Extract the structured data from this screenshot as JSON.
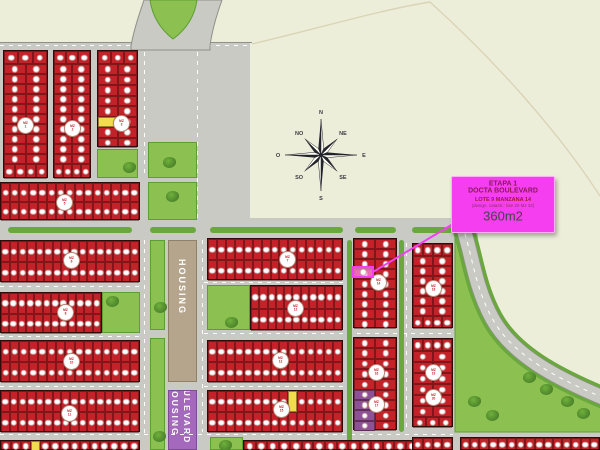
{
  "info_box": {
    "etapa": "ETAPA 1",
    "project": "DOCTA BOULEVARD",
    "lote": "LOTE 9 MANZANA 14",
    "catastro": "(design. catastr.:  lote 20 Mz 32)",
    "area": "360m2"
  },
  "selected_lot": {
    "etapa": "1",
    "manzana": "14",
    "lote": "9",
    "area_m2": 360
  },
  "compass": {
    "labels": [
      "N",
      "NE",
      "E",
      "SE",
      "S",
      "SO",
      "O",
      "NO"
    ]
  },
  "street_labels": {
    "housing_road": "HOUSING",
    "boulevard_word1": "HOUSING",
    "boulevard_word2": "BOULEVARD"
  },
  "commercial_blocks": [
    {
      "area": "7200.00 m2",
      "desc1": "Lote destinado a uso",
      "desc2": "comercial. residencial"
    },
    {
      "area": "7500.00 m2",
      "desc1": "Lote destinado a uso",
      "desc2": "comercial. residencial"
    }
  ],
  "legend_colors": {
    "lot_red": "#c32228",
    "lot_yellow": "#f0dc4e",
    "lot_purple": "#8d5196",
    "park_green": "#8cc152",
    "road_gray": "#c9cac3",
    "median_green": "#6aa83e",
    "strip_tan": "#b5a58d",
    "strip_purple": "#a469bd",
    "highlight_magenta": "#f23ff0"
  },
  "map": {
    "road_panels": [
      [
        0,
        42,
        250,
        408
      ],
      [
        197,
        218,
        281,
        232
      ],
      [
        453,
        425,
        147,
        25
      ]
    ],
    "dashes_h": [
      [
        0,
        45,
        250
      ],
      [
        0,
        286,
        140
      ],
      [
        0,
        336,
        140
      ],
      [
        0,
        386,
        140
      ],
      [
        0,
        434,
        453
      ],
      [
        204,
        282,
        139
      ],
      [
        204,
        333,
        256
      ],
      [
        204,
        386,
        139
      ]
    ],
    "dashes_v": [
      [
        144,
        52,
        126
      ],
      [
        197,
        52,
        166
      ],
      [
        144,
        240,
        194
      ],
      [
        202,
        240,
        192
      ],
      [
        406,
        243,
        188
      ]
    ],
    "medians": [
      [
        8,
        227,
        124,
        6
      ],
      [
        150,
        227,
        46,
        6
      ],
      [
        210,
        227,
        133,
        6
      ],
      [
        355,
        227,
        41,
        6
      ],
      [
        412,
        227,
        41,
        6
      ],
      [
        347,
        240,
        5,
        210
      ],
      [
        399,
        240,
        5,
        192
      ]
    ],
    "bars": [
      [
        455,
        232,
        7,
        200
      ]
    ],
    "parks": [
      [
        97,
        149,
        41,
        29
      ],
      [
        102,
        292,
        38,
        41
      ],
      [
        207,
        285,
        43,
        45
      ],
      [
        148,
        142,
        49,
        36
      ],
      [
        148,
        182,
        49,
        38
      ],
      [
        150,
        240,
        15,
        90
      ],
      [
        150,
        338,
        15,
        112
      ],
      [
        210,
        437,
        33,
        13
      ]
    ],
    "curve_trees": [
      [
        540,
        384
      ],
      [
        561,
        396
      ],
      [
        523,
        372
      ],
      [
        577,
        408
      ],
      [
        468,
        396
      ],
      [
        486,
        410
      ]
    ],
    "blocks": [
      {
        "name": "mz-1",
        "x": 3,
        "y": 50,
        "w": 45,
        "h": 128,
        "groups": [
          [
            1,
            3,
            13
          ],
          [
            10,
            2,
            10
          ],
          [
            1,
            4,
            15
          ]
        ],
        "specials": []
      },
      {
        "name": "mz-2",
        "x": 53,
        "y": 50,
        "w": 38,
        "h": 128,
        "groups": [
          [
            1,
            3,
            13
          ],
          [
            10,
            2,
            10
          ],
          [
            1,
            4,
            15
          ]
        ],
        "specials": []
      },
      {
        "name": "mz-3",
        "x": 97,
        "y": 50,
        "w": 41,
        "h": 97,
        "groups": [
          [
            1,
            3,
            13
          ],
          [
            8,
            2,
            10.5
          ]
        ],
        "specials": [
          [
            1,
            5,
            0,
            "lot_yellow"
          ]
        ]
      },
      {
        "name": "mz-5",
        "x": 0,
        "y": 182,
        "w": 140,
        "h": 38,
        "groups": [
          [
            2,
            15,
            19
          ]
        ],
        "specials": []
      },
      {
        "name": "mz-6",
        "x": 0,
        "y": 240,
        "w": 140,
        "h": 42,
        "groups": [
          [
            2,
            16,
            21
          ]
        ],
        "specials": []
      },
      {
        "name": "mz-8",
        "x": 0,
        "y": 292,
        "w": 102,
        "h": 41,
        "groups": [
          [
            2,
            12,
            20.5
          ]
        ],
        "specials": []
      },
      {
        "name": "mz-10",
        "x": 0,
        "y": 340,
        "w": 140,
        "h": 42,
        "groups": [
          [
            2,
            15,
            21
          ]
        ],
        "specials": []
      },
      {
        "name": "mz-11",
        "x": 0,
        "y": 390,
        "w": 140,
        "h": 42,
        "groups": [
          [
            2,
            16,
            21
          ]
        ],
        "specials": []
      },
      {
        "name": "row-south-left",
        "x": 0,
        "y": 440,
        "w": 140,
        "h": 10,
        "groups": [
          [
            1,
            14,
            10
          ]
        ],
        "specials": [
          [
            0,
            0,
            3,
            "lot_yellow"
          ]
        ]
      },
      {
        "name": "mz-7",
        "x": 207,
        "y": 238,
        "w": 136,
        "h": 42,
        "groups": [
          [
            2,
            15,
            21
          ]
        ],
        "specials": []
      },
      {
        "name": "mz-12",
        "x": 250,
        "y": 285,
        "w": 93,
        "h": 45,
        "groups": [
          [
            2,
            11,
            22.5
          ]
        ],
        "specials": []
      },
      {
        "name": "mz-13",
        "x": 207,
        "y": 340,
        "w": 136,
        "h": 42,
        "groups": [
          [
            2,
            15,
            21
          ]
        ],
        "specials": []
      },
      {
        "name": "mz-15",
        "x": 207,
        "y": 390,
        "w": 136,
        "h": 42,
        "groups": [
          [
            2,
            15,
            21
          ]
        ],
        "specials": [
          [
            0,
            0,
            9,
            "lot_yellow"
          ]
        ]
      },
      {
        "name": "row-south-mid",
        "x": 243,
        "y": 440,
        "w": 187,
        "h": 10,
        "groups": [
          [
            1,
            16,
            10
          ]
        ],
        "specials": []
      },
      {
        "name": "mz-14",
        "x": 353,
        "y": 238,
        "w": 44,
        "h": 90,
        "groups": [
          [
            9,
            2,
            10
          ]
        ],
        "specials": []
      },
      {
        "name": "mz-16-17",
        "x": 353,
        "y": 337,
        "w": 44,
        "h": 93,
        "groups": [
          [
            9,
            2,
            10.34
          ]
        ],
        "specials": [
          [
            0,
            5,
            0,
            "lot_purple"
          ],
          [
            0,
            6,
            0,
            "lot_purple"
          ],
          [
            0,
            7,
            0,
            "lot_purple"
          ],
          [
            0,
            8,
            0,
            "lot_purple"
          ]
        ]
      },
      {
        "name": "mz-18",
        "x": 412,
        "y": 243,
        "w": 41,
        "h": 85,
        "groups": [
          [
            1,
            4,
            12
          ],
          [
            6,
            2,
            10
          ],
          [
            1,
            4,
            13
          ]
        ],
        "specials": []
      },
      {
        "name": "mz-19-20",
        "x": 412,
        "y": 338,
        "w": 41,
        "h": 89,
        "groups": [
          [
            1,
            4,
            12
          ],
          [
            6,
            2,
            11
          ],
          [
            1,
            3,
            11
          ]
        ],
        "specials": []
      },
      {
        "name": "row-south-right",
        "x": 412,
        "y": 437,
        "w": 41,
        "h": 13,
        "groups": [
          [
            1,
            4,
            13
          ]
        ],
        "specials": []
      },
      {
        "name": "row-south-far-right",
        "x": 460,
        "y": 437,
        "w": 140,
        "h": 13,
        "groups": [
          [
            1,
            15,
            13
          ]
        ],
        "specials": []
      }
    ],
    "badges": [
      [
        24,
        124,
        "1"
      ],
      [
        71,
        127,
        "2"
      ],
      [
        120,
        122,
        "3"
      ],
      [
        63,
        201,
        "5"
      ],
      [
        70,
        259,
        "6"
      ],
      [
        64,
        311,
        "8"
      ],
      [
        70,
        360,
        "10"
      ],
      [
        68,
        412,
        "11"
      ],
      [
        286,
        258,
        "7"
      ],
      [
        294,
        307,
        "12"
      ],
      [
        279,
        359,
        "13"
      ],
      [
        280,
        408,
        "15"
      ],
      [
        377,
        281,
        "14"
      ],
      [
        375,
        371,
        "16"
      ],
      [
        375,
        403,
        "17"
      ],
      [
        432,
        287,
        "18"
      ],
      [
        432,
        371,
        "19"
      ],
      [
        432,
        396,
        "20"
      ]
    ],
    "badge_prefix": "MZ",
    "callout": {
      "x1": 373,
      "y1": 272,
      "x2": 453,
      "y2": 224
    },
    "highlight": [
      352,
      266,
      22,
      12
    ]
  }
}
